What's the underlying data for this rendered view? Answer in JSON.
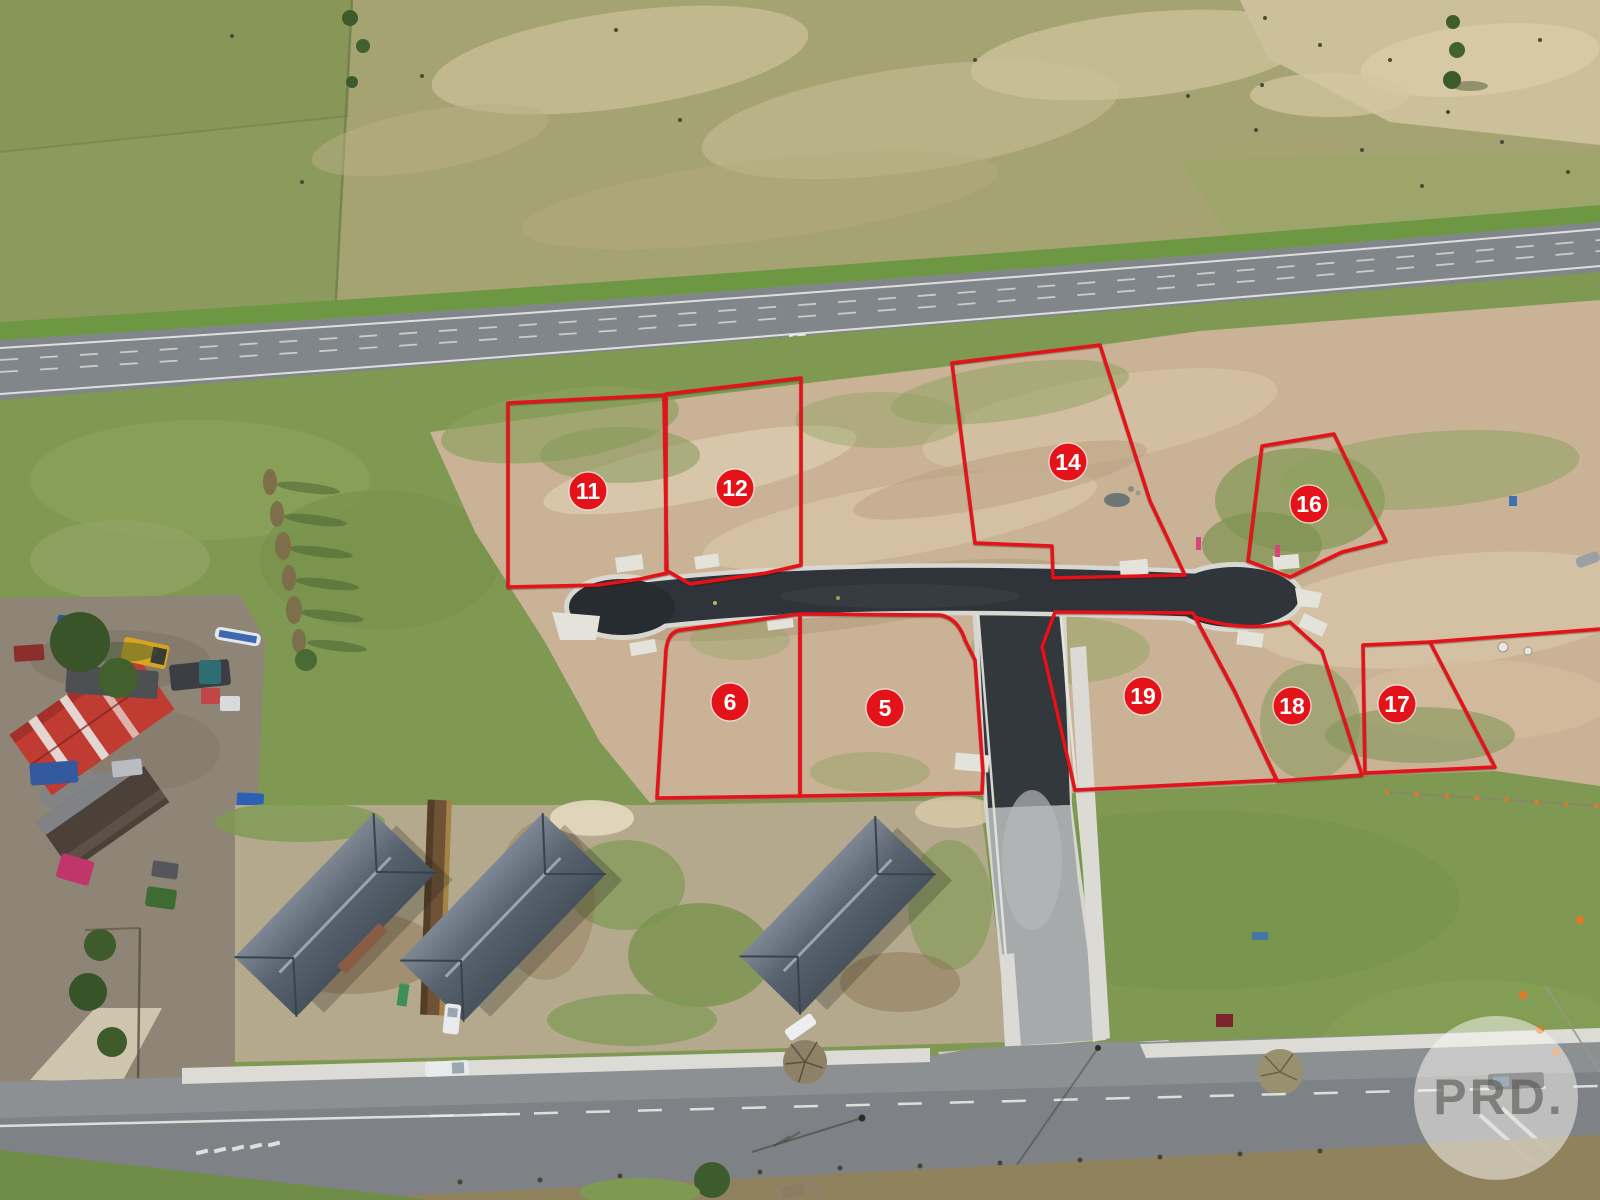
{
  "watermark": {
    "text": "PRD.",
    "circle_color": "#faf8f3",
    "text_color": "#55554f"
  },
  "overlay": {
    "line_color": "#e4131a",
    "badge_fill": "#e4131a",
    "badge_text_color": "#ffffff",
    "badge_radius": 19
  },
  "lots": [
    {
      "number": "11",
      "badge_x": 588,
      "badge_y": 491,
      "path": "M508,403 L664,395 L667,573 L640,579 L598,585 L508,587 Z"
    },
    {
      "number": "12",
      "badge_x": 735,
      "badge_y": 488,
      "path": "M666,394 L801,378 L801,565 L766,573 L690,584 L666,570 Z"
    },
    {
      "number": "14",
      "badge_x": 1068,
      "badge_y": 462,
      "path": "M952,363 L1100,345 L1150,501 L1185,575 L1053,578 L1052,546 L975,543 Z"
    },
    {
      "number": "16",
      "badge_x": 1309,
      "badge_y": 504,
      "path": "M1262,446 L1334,434 L1386,541 L1342,552 L1290,577 L1248,561 Z"
    },
    {
      "number": "6",
      "badge_x": 730,
      "badge_y": 702,
      "path": "M680,630 Q668,632 666,650 L657,798 L800,796 L800,614 Z"
    },
    {
      "number": "5",
      "badge_x": 885,
      "badge_y": 708,
      "path": "M800,614 L940,615 Q958,618 965,640 L975,660 L983,772 L982,793 L800,796 Z"
    },
    {
      "number": "19",
      "badge_x": 1143,
      "badge_y": 696,
      "path": "M1055,612 L1193,613 L1235,692 L1277,780 L1075,790 L1042,647 Z"
    },
    {
      "number": "18",
      "badge_x": 1292,
      "badge_y": 706,
      "path": "M1195,617 Q1245,633 1290,622 L1322,651 L1362,775 L1277,781 L1235,692 Z"
    },
    {
      "number": "17",
      "badge_x": 1397,
      "badge_y": 704,
      "path": "M1363,645 L1430,642 L1495,767 L1365,773 Z"
    }
  ],
  "extra_boundary_lines": [
    "M1430,642 L1600,629"
  ],
  "scene_colors": {
    "pasture_top": "#a6a372",
    "pasture_green": "#7f9852",
    "highway_asphalt": "#81868b",
    "estate_road_asphalt": "#2e343a",
    "concrete_kerb": "#d9d8d2",
    "cleared_dirt": "#c9b295",
    "roof_slate": "#57626e",
    "shed_red": "#c03b31"
  }
}
